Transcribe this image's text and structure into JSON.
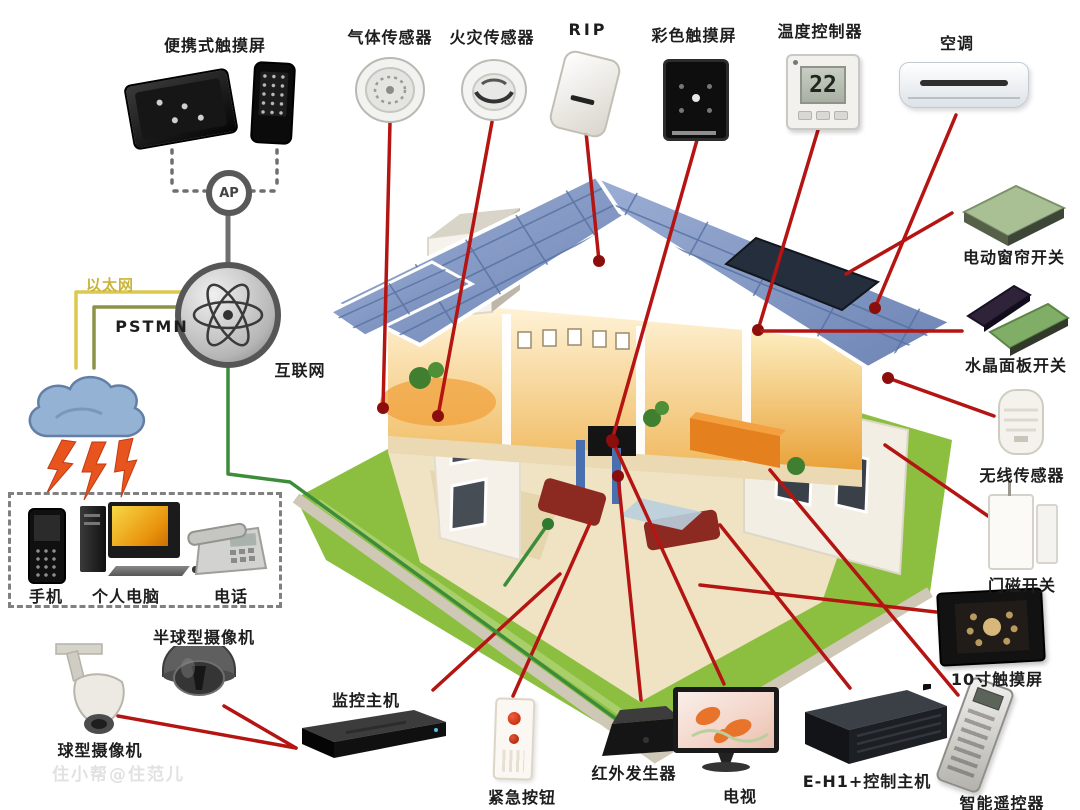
{
  "watermark": "住小帮@住范儿",
  "network": {
    "ap_label": "AP",
    "ethernet_label": "以太网",
    "pstn_label": "PSTMN",
    "internet_label": "互联网"
  },
  "devices": {
    "portable_touch": {
      "label": "便携式触摸屏"
    },
    "gas_sensor": {
      "label": "气体传感器"
    },
    "fire_sensor": {
      "label": "火灾传感器"
    },
    "rip": {
      "label": "RIP"
    },
    "color_touch": {
      "label": "彩色触摸屏"
    },
    "temp_controller": {
      "label": "温度控制器",
      "display_value": "22"
    },
    "air_conditioner": {
      "label": "空调"
    },
    "curtain_switch": {
      "label": "电动窗帘开关"
    },
    "crystal_panel": {
      "label": "水晶面板开关"
    },
    "wireless_sensor": {
      "label": "无线传感器"
    },
    "door_magnet": {
      "label": "门磁开关"
    },
    "touch10": {
      "label": "10寸触摸屏"
    },
    "smart_remote": {
      "label": "智能遥控器"
    },
    "eh1_host": {
      "label": "E-H1+控制主机"
    },
    "tv": {
      "label": "电视"
    },
    "ir_generator": {
      "label": "红外发生器"
    },
    "emergency_button": {
      "label": "紧急按钮"
    },
    "monitor_host": {
      "label": "监控主机"
    },
    "dome_camera": {
      "label": "半球型摄像机"
    },
    "ball_camera": {
      "label": "球型摄像机"
    },
    "mobile_phone": {
      "label": "手机"
    },
    "pc": {
      "label": "个人电脑"
    },
    "telephone": {
      "label": "电话"
    }
  },
  "colors": {
    "wire_red": "#b51512",
    "wire_green": "#3c8c3c",
    "wire_yellow": "#dcc84e",
    "wire_olive": "#8e9247",
    "wire_gray": "#6f6f6f",
    "dot_red": "#8c0e0c",
    "dot_green": "#2e7a2e",
    "roof": "#8299c7",
    "lawn": "#8cbf3f",
    "interior_warm": "#f0b95e"
  },
  "wires": [
    {
      "color": "red",
      "points": [
        [
          390,
          122
        ],
        [
          383,
          408
        ]
      ],
      "dot": true
    },
    {
      "color": "red",
      "points": [
        [
          492,
          122
        ],
        [
          438,
          416
        ]
      ],
      "dot": true
    },
    {
      "color": "red",
      "points": [
        [
          586,
          132
        ],
        [
          599,
          261
        ]
      ],
      "dot": true
    },
    {
      "color": "red",
      "points": [
        [
          697,
          140
        ],
        [
          612,
          440
        ]
      ],
      "dot": true
    },
    {
      "color": "red",
      "points": [
        [
          818,
          130
        ],
        [
          758,
          330
        ]
      ],
      "dot": true
    },
    {
      "color": "red",
      "points": [
        [
          956,
          115
        ],
        [
          875,
          308
        ]
      ],
      "dot": true
    },
    {
      "color": "red",
      "points": [
        [
          962,
          331
        ],
        [
          762,
          331
        ]
      ],
      "dot": false
    },
    {
      "color": "red",
      "points": [
        [
          952,
          213
        ],
        [
          846,
          274
        ]
      ],
      "dot": false
    },
    {
      "color": "red",
      "points": [
        [
          994,
          416
        ],
        [
          888,
          378
        ]
      ],
      "dot": true
    },
    {
      "color": "red",
      "points": [
        [
          988,
          516
        ],
        [
          885,
          445
        ]
      ],
      "dot": false
    },
    {
      "color": "red",
      "points": [
        [
          936,
          612
        ],
        [
          700,
          585
        ]
      ],
      "dot": false
    },
    {
      "color": "red",
      "points": [
        [
          724,
          684
        ],
        [
          613,
          442
        ]
      ],
      "dot": true
    },
    {
      "color": "red",
      "points": [
        [
          641,
          700
        ],
        [
          618,
          476
        ]
      ],
      "dot": true
    },
    {
      "color": "red",
      "points": [
        [
          513,
          696
        ],
        [
          590,
          523
        ]
      ],
      "dot": false
    },
    {
      "color": "red",
      "points": [
        [
          433,
          690
        ],
        [
          560,
          574
        ]
      ],
      "dot": false
    },
    {
      "color": "red",
      "points": [
        [
          850,
          688
        ],
        [
          720,
          525
        ]
      ],
      "dot": false
    },
    {
      "color": "red",
      "points": [
        [
          958,
          695
        ],
        [
          770,
          470
        ]
      ],
      "dot": false
    },
    {
      "color": "red",
      "points": [
        [
          118,
          716
        ],
        [
          296,
          748
        ]
      ],
      "dot": false
    },
    {
      "color": "red",
      "points": [
        [
          224,
          706
        ],
        [
          296,
          748
        ]
      ],
      "dot": false
    },
    {
      "color": "green",
      "points": [
        [
          228,
          368
        ],
        [
          228,
          474
        ],
        [
          290,
          482
        ],
        [
          652,
          745
        ]
      ],
      "dot": false
    },
    {
      "color": "green",
      "points": [
        [
          505,
          585
        ],
        [
          548,
          524
        ]
      ],
      "dot": true
    },
    {
      "color": "yellow",
      "points": [
        [
          181,
          292
        ],
        [
          76,
          292
        ],
        [
          76,
          368
        ]
      ],
      "dot": false
    },
    {
      "color": "olive",
      "points": [
        [
          181,
          307
        ],
        [
          94,
          307
        ],
        [
          94,
          368
        ]
      ],
      "dot": false
    },
    {
      "color": "gray",
      "points": [
        [
          228,
          212
        ],
        [
          228,
          263
        ]
      ],
      "dot": false,
      "width": 5
    },
    {
      "color": "gray",
      "points": [
        [
          172,
          150
        ],
        [
          172,
          186
        ]
      ],
      "dash": true
    },
    {
      "color": "gray",
      "points": [
        [
          174,
          191
        ],
        [
          205,
          191
        ]
      ],
      "dash": true
    },
    {
      "color": "gray",
      "points": [
        [
          277,
          150
        ],
        [
          277,
          186
        ]
      ],
      "dash": true
    },
    {
      "color": "gray",
      "points": [
        [
          251,
          191
        ],
        [
          275,
          191
        ]
      ],
      "dash": true
    }
  ]
}
